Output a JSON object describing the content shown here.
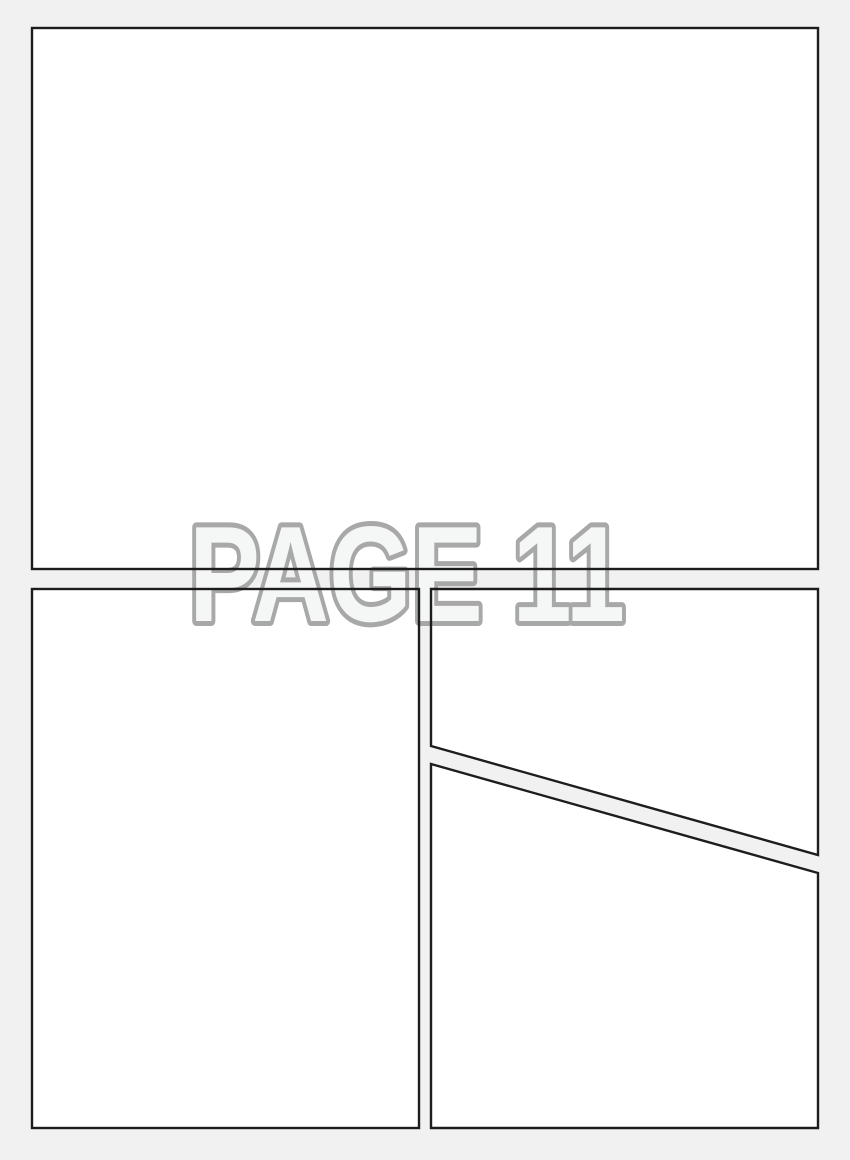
{
  "watermark": {
    "text": "PAGE 11"
  },
  "colors": {
    "page_background": "#f1f1f2",
    "panel_fill": "#ffffff",
    "panel_border": "#1d1d1d",
    "watermark_fill": "#f5f6f6",
    "watermark_outline": "#a8a8a8"
  },
  "panels": [
    {
      "id": "panel-1",
      "position": "top-full-width"
    },
    {
      "id": "panel-2",
      "position": "bottom-left"
    },
    {
      "id": "panel-3",
      "position": "bottom-right-upper-diagonal"
    },
    {
      "id": "panel-4",
      "position": "bottom-right-lower-diagonal"
    }
  ]
}
